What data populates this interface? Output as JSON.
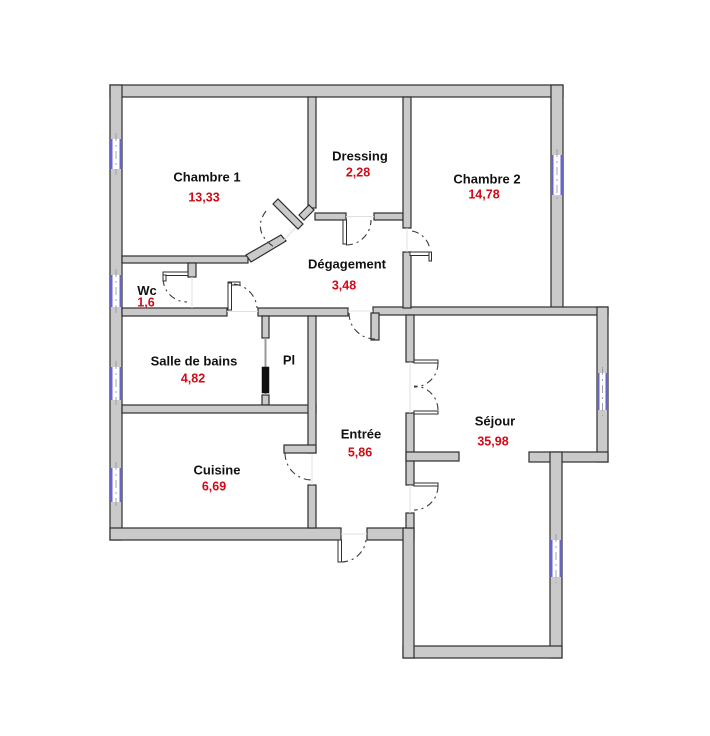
{
  "plan": {
    "rooms": [
      {
        "id": "chambre-1",
        "name": "Chambre 1",
        "area": "13,33"
      },
      {
        "id": "dressing",
        "name": "Dressing",
        "area": "2,28"
      },
      {
        "id": "chambre-2",
        "name": "Chambre 2",
        "area": "14,78"
      },
      {
        "id": "degagement",
        "name": "Dégagement",
        "area": "3,48"
      },
      {
        "id": "wc",
        "name": "Wc",
        "area": "1,6"
      },
      {
        "id": "salle-de-bains",
        "name": "Salle de bains",
        "area": "4,82"
      },
      {
        "id": "placard",
        "name": "Pl",
        "area": ""
      },
      {
        "id": "cuisine",
        "name": "Cuisine",
        "area": "6,69"
      },
      {
        "id": "entree",
        "name": "Entrée",
        "area": "5,86"
      },
      {
        "id": "sejour",
        "name": "Séjour",
        "area": "35,98"
      }
    ],
    "colors": {
      "background": "#ffffff",
      "wall_fill": "#cacaca",
      "wall_edge": "#2d2d2d",
      "room_name": "#111111",
      "room_area": "#d10a17",
      "window": "#6565c8",
      "sliding_door": "#111111"
    }
  }
}
